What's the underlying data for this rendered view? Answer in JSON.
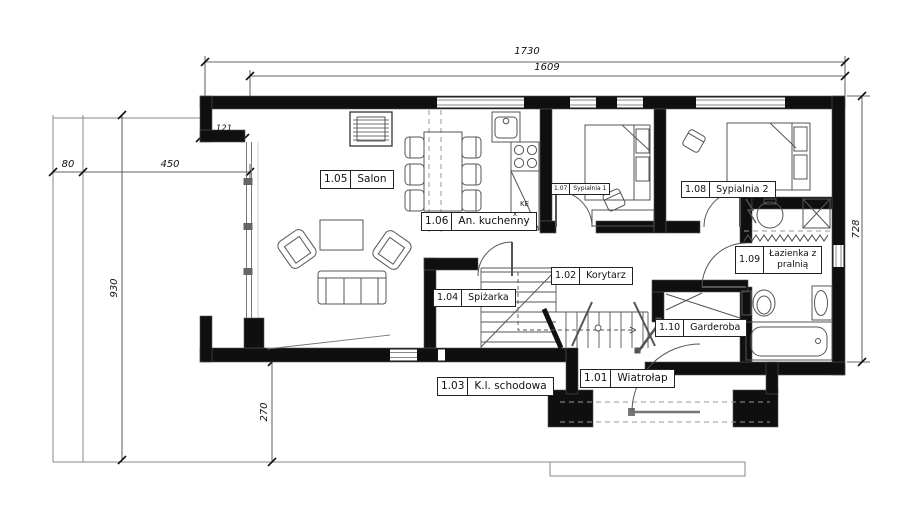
{
  "drawing": {
    "type": "floor-plan",
    "storey": "parter"
  },
  "rooms": [
    {
      "id": "1.01",
      "name": "Wiatrołap"
    },
    {
      "id": "1.02",
      "name": "Korytarz"
    },
    {
      "id": "1.03",
      "name": "K.l. schodowa"
    },
    {
      "id": "1.04",
      "name": "Spiżarka"
    },
    {
      "id": "1.05",
      "name": "Salon"
    },
    {
      "id": "1.06",
      "name": "An. kuchenny"
    },
    {
      "id": "1.07",
      "name": "Sypialnia 1"
    },
    {
      "id": "1.08",
      "name": "Sypialnia 2"
    },
    {
      "id": "1.09",
      "name": "Łazienka z",
      "name2": "pralnią",
      "full_name": "Łazienka z pralnią"
    },
    {
      "id": "1.10",
      "name": "Garderoba"
    }
  ],
  "dimensions": {
    "total_width": "1730",
    "glazed_width": "1609",
    "corner_offset": "121",
    "terrace_strip": "80",
    "terrace_width": "450",
    "left_depth": "930",
    "terrace_depth": "270",
    "right_depth": "728"
  },
  "kitchen_annotations": {
    "counter_mark": "KE",
    "cross_mark": "x"
  },
  "colors": {
    "wall": "#0f0f0f",
    "line": "#555555",
    "construction": "#999999",
    "background": "#ffffff"
  }
}
